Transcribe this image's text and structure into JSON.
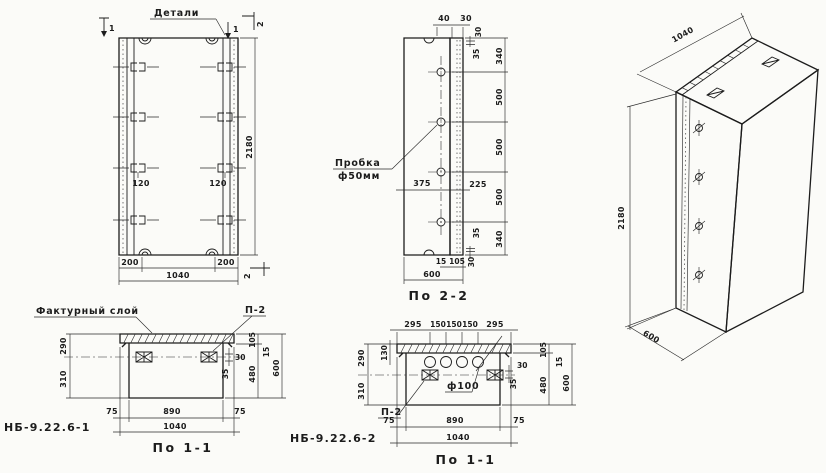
{
  "page": {
    "background": "#fbfbf8",
    "ink": "#1c1c1c"
  },
  "front_view": {
    "title": "Детали",
    "section_mark_1_left": "1",
    "section_mark_1_right": "1",
    "section_mark_2_top": "2",
    "section_mark_2_bottom": "2",
    "dim_height": "2180",
    "dim_width": "1040",
    "dim_left_offset": "200",
    "dim_right_offset": "200",
    "dim_anchor_left": "120",
    "dim_anchor_right": "120"
  },
  "section_2_2": {
    "title": "По 2-2",
    "plug_label_line1": "Пробка",
    "plug_label_line2": "ф50мм",
    "dim_top_40": "40",
    "dim_top_30": "30",
    "dim_edge_30_top": "30",
    "dim_edge_35_top": "35",
    "dim_340_top": "340",
    "dim_500_1": "500",
    "dim_500_2": "500",
    "dim_500_3": "500",
    "dim_340_bottom": "340",
    "dim_edge_35_bottom": "35",
    "dim_edge_30_bottom": "30",
    "dim_375": "375",
    "dim_225": "225",
    "dim_15": "15",
    "dim_105": "105",
    "dim_600": "600"
  },
  "isometric_view": {
    "dim_width": "1040",
    "dim_height": "2180",
    "dim_depth": "600"
  },
  "section_1_1_a": {
    "code": "НБ-9.22.6-1",
    "title": "По 1-1",
    "label_facing_layer": "Фактурный слой",
    "label_anchor": "П-2",
    "dim_290": "290",
    "dim_310": "310",
    "dim_30": "30",
    "dim_35": "35",
    "dim_105": "105",
    "dim_15": "15",
    "dim_480": "480",
    "dim_600": "600",
    "dim_75_left": "75",
    "dim_890": "890",
    "dim_75_right": "75",
    "dim_1040": "1040"
  },
  "section_1_1_b": {
    "code": "НБ-9.22.6-2",
    "title": "По 1-1",
    "label_anchor": "П-2",
    "label_hole": "ф100",
    "dim_295_left": "295",
    "dim_150_1": "150",
    "dim_150_2": "150",
    "dim_150_3": "150",
    "dim_295_right": "295",
    "dim_130": "130",
    "dim_290": "290",
    "dim_310": "310",
    "dim_30": "30",
    "dim_35": "35",
    "dim_105": "105",
    "dim_15": "15",
    "dim_480": "480",
    "dim_600": "600",
    "dim_75_left": "75",
    "dim_890": "890",
    "dim_75_right": "75",
    "dim_1040": "1040"
  }
}
